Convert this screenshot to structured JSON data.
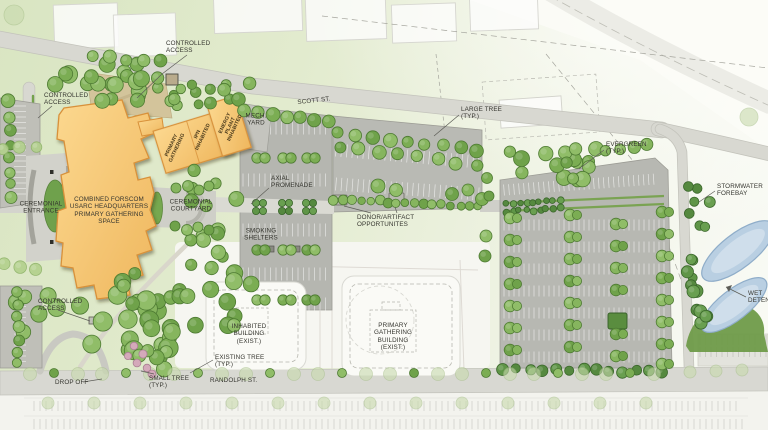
{
  "plan_labels": {
    "controlled_access_top": "CONTROLLED\nACCESS",
    "controlled_access_left": "CONTROLLED\nACCESS",
    "controlled_access_bottom": "CONTROLLED\nACCESS",
    "ceremonial_entrance": "CEREMONIAL\nENTRANCE",
    "headquarters": "COMBINED FORSCOM\nUSARC HEADQUARTERS\nPRIMARY GATHERING\nSPACE",
    "ceremonial_courtyard": "CEREMONIAL\nCOURTYARD",
    "mech_yard": "MECH.\nYARD",
    "axial_promenade": "AXIAL\nPROMENADE",
    "smoking_shelters": "SMOKING\nSHELTERS",
    "donor_artifact": "DONOR/ARTIFACT\nOPPORTUNITES",
    "scott_st": "SCOTT ST.",
    "randolph_st": "RANDOLPH ST.",
    "large_tree": "LARGE TREE\n(TYP.)",
    "evergreen": "EVERGREEN\n(TYP.)",
    "stormwater_forebay": "STORMWATER\nFOREBAY",
    "wet_detention": "WET\nDETENTION",
    "inhabited_building": "INHABITED\nBUILDING\n(EXIST.)",
    "primary_gathering_building": "PRIMARY\nGATHERING\nBUILDING\n(EXIST.)",
    "existing_tree": "EXISTING TREE\n(TYP.)",
    "small_tree": "SMALL TREE\n(TYP.)",
    "drop_off": "DROP OFF",
    "bldg_primary_gathering": "PRIMARY\nGATHERING",
    "bldg_ipn": "IPN\nINHABITED",
    "bldg_energy_plant": "ENERGY\nPLANT\nINHABITED"
  },
  "colors": {
    "building_accent": "#f6c36d",
    "building_outline": "#d8913a",
    "tree_green": "#7fae57",
    "evergreen_green": "#5d9246",
    "asphalt": "#b6b7b0",
    "road_gray": "#d8d8d1",
    "pond_blue": "#b9cfe2",
    "wetland_green": "#6f9b49",
    "parade_tan": "#d3c49b",
    "label_ink": "#35352f"
  }
}
